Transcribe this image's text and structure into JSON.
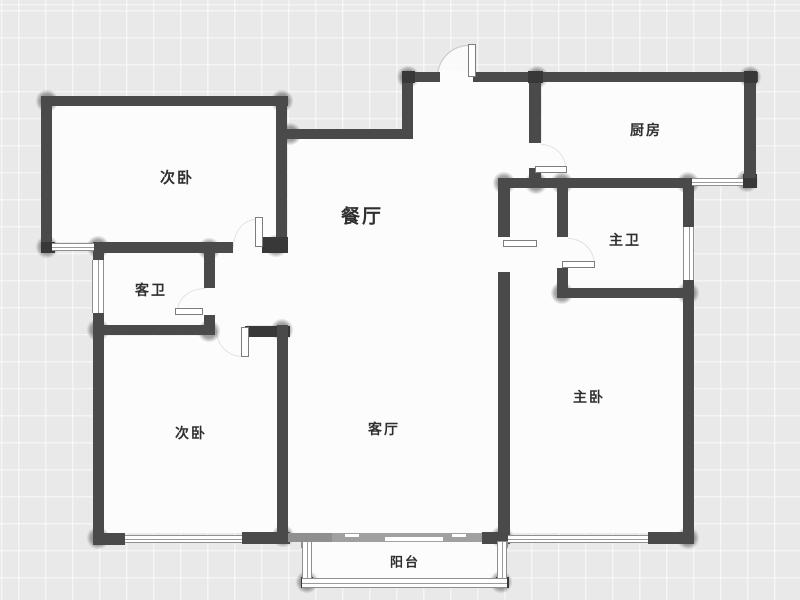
{
  "canvas": {
    "width": 800,
    "height": 600
  },
  "palette": {
    "outside": "#e9e9e9",
    "grid_line": "#ffffff",
    "interior": "#fcfcfc",
    "wall": "#4a4a4a",
    "wall_dark": "#383838",
    "wall_medium": "#8f8f8f",
    "window_line": "#8f8f8f",
    "door_line": "#7d7d7d",
    "arc_line": "#c6c6c6",
    "label_color": "#2f2f2f",
    "slider": "#a0a0a0"
  },
  "rooms": [
    {
      "id": "bedroom-top",
      "label": "次卧",
      "cx": 177,
      "cy": 177,
      "size": 15,
      "weight": 600
    },
    {
      "id": "dining",
      "label": "餐厅",
      "cx": 362,
      "cy": 215,
      "size": 19,
      "weight": 700
    },
    {
      "id": "kitchen",
      "label": "厨房",
      "cx": 646,
      "cy": 130,
      "size": 14,
      "weight": 600
    },
    {
      "id": "master-bath",
      "label": "主卫",
      "cx": 625,
      "cy": 240,
      "size": 14,
      "weight": 600
    },
    {
      "id": "guest-bath",
      "label": "客卫",
      "cx": 151,
      "cy": 290,
      "size": 14,
      "weight": 600
    },
    {
      "id": "bedroom-bottom",
      "label": "次卧",
      "cx": 191,
      "cy": 433,
      "size": 14,
      "weight": 600
    },
    {
      "id": "living",
      "label": "客厅",
      "cx": 384,
      "cy": 429,
      "size": 14,
      "weight": 600
    },
    {
      "id": "master-bedroom",
      "label": "主卧",
      "cx": 589,
      "cy": 397,
      "size": 14,
      "weight": 600
    },
    {
      "id": "balcony",
      "label": "阳台",
      "cx": 405,
      "cy": 561,
      "size": 13,
      "weight": 600
    }
  ],
  "floor_rects": [
    [
      52,
      106,
      224,
      136
    ],
    [
      104,
      253,
      100,
      72
    ],
    [
      104,
      336,
      173,
      197
    ],
    [
      215,
      253,
      73,
      72
    ],
    [
      288,
      139,
      210,
      394
    ],
    [
      413,
      82,
      117,
      96
    ],
    [
      542,
      82,
      202,
      96
    ],
    [
      510,
      188,
      47,
      110
    ],
    [
      568,
      188,
      115,
      100
    ],
    [
      510,
      298,
      173,
      235
    ],
    [
      312,
      542,
      185,
      36
    ],
    [
      230,
      242,
      46,
      11
    ],
    [
      213,
      325,
      34,
      12
    ],
    [
      204,
      286,
      11,
      30
    ],
    [
      530,
      142,
      12,
      27
    ],
    [
      557,
      236,
      11,
      33
    ],
    [
      498,
      236,
      12,
      37
    ],
    [
      439,
      71,
      35,
      11
    ]
  ],
  "walls": [
    {
      "x": 41,
      "y": 96,
      "w": 247,
      "h": 10,
      "shade": "wall"
    },
    {
      "x": 41,
      "y": 96,
      "w": 11,
      "h": 157,
      "shade": "wall"
    },
    {
      "x": 276,
      "y": 96,
      "w": 11,
      "h": 156,
      "shade": "wall"
    },
    {
      "x": 41,
      "y": 242,
      "w": 14,
      "h": 11,
      "shade": "dark"
    },
    {
      "x": 93,
      "y": 242,
      "w": 140,
      "h": 11,
      "shade": "wall"
    },
    {
      "x": 262,
      "y": 237,
      "w": 26,
      "h": 16,
      "shade": "dark"
    },
    {
      "x": 93,
      "y": 243,
      "w": 11,
      "h": 19,
      "shade": "wall"
    },
    {
      "x": 93,
      "y": 313,
      "w": 11,
      "h": 232,
      "shade": "wall"
    },
    {
      "x": 93,
      "y": 325,
      "w": 122,
      "h": 10,
      "shade": "wall"
    },
    {
      "x": 204,
      "y": 245,
      "w": 11,
      "h": 43,
      "shade": "wall"
    },
    {
      "x": 204,
      "y": 315,
      "w": 11,
      "h": 14,
      "shade": "wall"
    },
    {
      "x": 245,
      "y": 326,
      "w": 45,
      "h": 11,
      "shade": "dark"
    },
    {
      "x": 277,
      "y": 325,
      "w": 11,
      "h": 214,
      "shade": "wall"
    },
    {
      "x": 93,
      "y": 533,
      "w": 32,
      "h": 12,
      "shade": "wall"
    },
    {
      "x": 242,
      "y": 532,
      "w": 48,
      "h": 12,
      "shade": "wall"
    },
    {
      "x": 288,
      "y": 533,
      "w": 49,
      "h": 9,
      "shade": "medium"
    },
    {
      "x": 482,
      "y": 532,
      "w": 28,
      "h": 12,
      "shade": "wall"
    },
    {
      "x": 648,
      "y": 532,
      "w": 46,
      "h": 12,
      "shade": "wall"
    },
    {
      "x": 683,
      "y": 178,
      "w": 11,
      "h": 49,
      "shade": "wall"
    },
    {
      "x": 683,
      "y": 280,
      "w": 11,
      "h": 264,
      "shade": "wall"
    },
    {
      "x": 498,
      "y": 178,
      "w": 196,
      "h": 10,
      "shade": "wall"
    },
    {
      "x": 743,
      "y": 174,
      "w": 14,
      "h": 14,
      "shade": "dark"
    },
    {
      "x": 744,
      "y": 72,
      "w": 12,
      "h": 106,
      "shade": "wall"
    },
    {
      "x": 529,
      "y": 78,
      "w": 12,
      "h": 65,
      "shade": "wall"
    },
    {
      "x": 529,
      "y": 168,
      "w": 12,
      "h": 20,
      "shade": "wall"
    },
    {
      "x": 402,
      "y": 72,
      "w": 38,
      "h": 10,
      "shade": "wall"
    },
    {
      "x": 473,
      "y": 72,
      "w": 285,
      "h": 10,
      "shade": "wall"
    },
    {
      "x": 402,
      "y": 72,
      "w": 11,
      "h": 67,
      "shade": "wall"
    },
    {
      "x": 285,
      "y": 129,
      "w": 128,
      "h": 10,
      "shade": "wall"
    },
    {
      "x": 402,
      "y": 71,
      "w": 13,
      "h": 12,
      "shade": "dark"
    },
    {
      "x": 528,
      "y": 71,
      "w": 15,
      "h": 12,
      "shade": "dark"
    },
    {
      "x": 744,
      "y": 71,
      "w": 13,
      "h": 12,
      "shade": "dark"
    },
    {
      "x": 498,
      "y": 178,
      "w": 12,
      "h": 59,
      "shade": "wall"
    },
    {
      "x": 498,
      "y": 272,
      "w": 12,
      "h": 261,
      "shade": "wall"
    },
    {
      "x": 557,
      "y": 187,
      "w": 11,
      "h": 50,
      "shade": "wall"
    },
    {
      "x": 557,
      "y": 268,
      "w": 11,
      "h": 30,
      "shade": "wall"
    },
    {
      "x": 557,
      "y": 288,
      "w": 137,
      "h": 10,
      "shade": "wall"
    },
    {
      "x": 301,
      "y": 577,
      "w": 12,
      "h": 11,
      "shade": "dark"
    },
    {
      "x": 496,
      "y": 577,
      "w": 13,
      "h": 11,
      "shade": "dark"
    },
    {
      "x": 301,
      "y": 541,
      "w": 11,
      "h": 7,
      "shade": "medium"
    },
    {
      "x": 497,
      "y": 541,
      "w": 11,
      "h": 7,
      "shade": "medium"
    }
  ],
  "windows": [
    {
      "x": 52,
      "y": 243,
      "w": 42,
      "h": 8,
      "orient": "h"
    },
    {
      "x": 92,
      "y": 260,
      "w": 12,
      "h": 53,
      "orient": "v"
    },
    {
      "x": 125,
      "y": 535,
      "w": 117,
      "h": 8,
      "orient": "h"
    },
    {
      "x": 508,
      "y": 535,
      "w": 140,
      "h": 8,
      "orient": "h"
    },
    {
      "x": 683,
      "y": 227,
      "w": 11,
      "h": 53,
      "orient": "v"
    },
    {
      "x": 692,
      "y": 178,
      "w": 51,
      "h": 8,
      "orient": "h"
    },
    {
      "x": 302,
      "y": 542,
      "w": 10,
      "h": 36,
      "orient": "v"
    },
    {
      "x": 302,
      "y": 578,
      "w": 205,
      "h": 10,
      "orient": "h"
    },
    {
      "x": 497,
      "y": 542,
      "w": 10,
      "h": 36,
      "orient": "v"
    }
  ],
  "door_leaves": [
    {
      "id": "entry-door-leaf",
      "x": 468,
      "y": 44,
      "w": 8,
      "h": 33
    },
    {
      "id": "bedroom-top-door-leaf",
      "x": 255,
      "y": 217,
      "w": 8,
      "h": 30
    },
    {
      "id": "bedroom-bottom-door-leaf",
      "x": 241,
      "y": 327,
      "w": 8,
      "h": 30
    },
    {
      "id": "guest-bath-door-leaf",
      "x": 175,
      "y": 308,
      "w": 28,
      "h": 7
    },
    {
      "id": "master-bath-door-leaf",
      "x": 562,
      "y": 261,
      "w": 33,
      "h": 7
    },
    {
      "id": "kitchen-door-leaf",
      "x": 535,
      "y": 166,
      "w": 32,
      "h": 7
    },
    {
      "id": "dining-pocket-door-leaf",
      "x": 503,
      "y": 240,
      "w": 34,
      "h": 7
    }
  ],
  "door_arcs": [
    {
      "id": "entry-door-arc",
      "x": 437,
      "y": 45,
      "w": 32,
      "h": 32,
      "corner": "tl",
      "strong": true
    },
    {
      "id": "bedroom-top-door-arc",
      "x": 233,
      "y": 219,
      "w": 23,
      "h": 28,
      "corner": "tl",
      "strong": false
    },
    {
      "id": "bedroom-bottom-door-arc",
      "x": 216,
      "y": 330,
      "w": 26,
      "h": 27,
      "corner": "bl",
      "strong": false
    },
    {
      "id": "guest-bath-door-arc",
      "x": 177,
      "y": 288,
      "w": 28,
      "h": 23,
      "corner": "tl",
      "strong": false
    },
    {
      "id": "master-bath-door-arc",
      "x": 568,
      "y": 238,
      "w": 27,
      "h": 27,
      "corner": "tr",
      "strong": false
    },
    {
      "id": "kitchen-door-arc",
      "x": 541,
      "y": 144,
      "w": 25,
      "h": 24,
      "corner": "tr",
      "strong": false
    }
  ],
  "balcony_slider": {
    "bar": [
      332,
      533,
      150,
      9
    ],
    "notches": [
      [
        345,
        534,
        14,
        3
      ],
      [
        452,
        534,
        14,
        3
      ],
      [
        385,
        537,
        58,
        4
      ]
    ]
  },
  "junction_shadows": [
    [
      47,
      101
    ],
    [
      282,
      101
    ],
    [
      408,
      77
    ],
    [
      537,
      77
    ],
    [
      750,
      77
    ],
    [
      290,
      134
    ],
    [
      47,
      247
    ],
    [
      98,
      247
    ],
    [
      209,
      249
    ],
    [
      276,
      246
    ],
    [
      504,
      183
    ],
    [
      536,
      183
    ],
    [
      562,
      183
    ],
    [
      688,
      183
    ],
    [
      747,
      181
    ],
    [
      98,
      330
    ],
    [
      209,
      331
    ],
    [
      282,
      330
    ],
    [
      562,
      293
    ],
    [
      688,
      293
    ],
    [
      98,
      538
    ],
    [
      283,
      536
    ],
    [
      502,
      537
    ],
    [
      688,
      538
    ],
    [
      307,
      582
    ],
    [
      501,
      582
    ]
  ]
}
